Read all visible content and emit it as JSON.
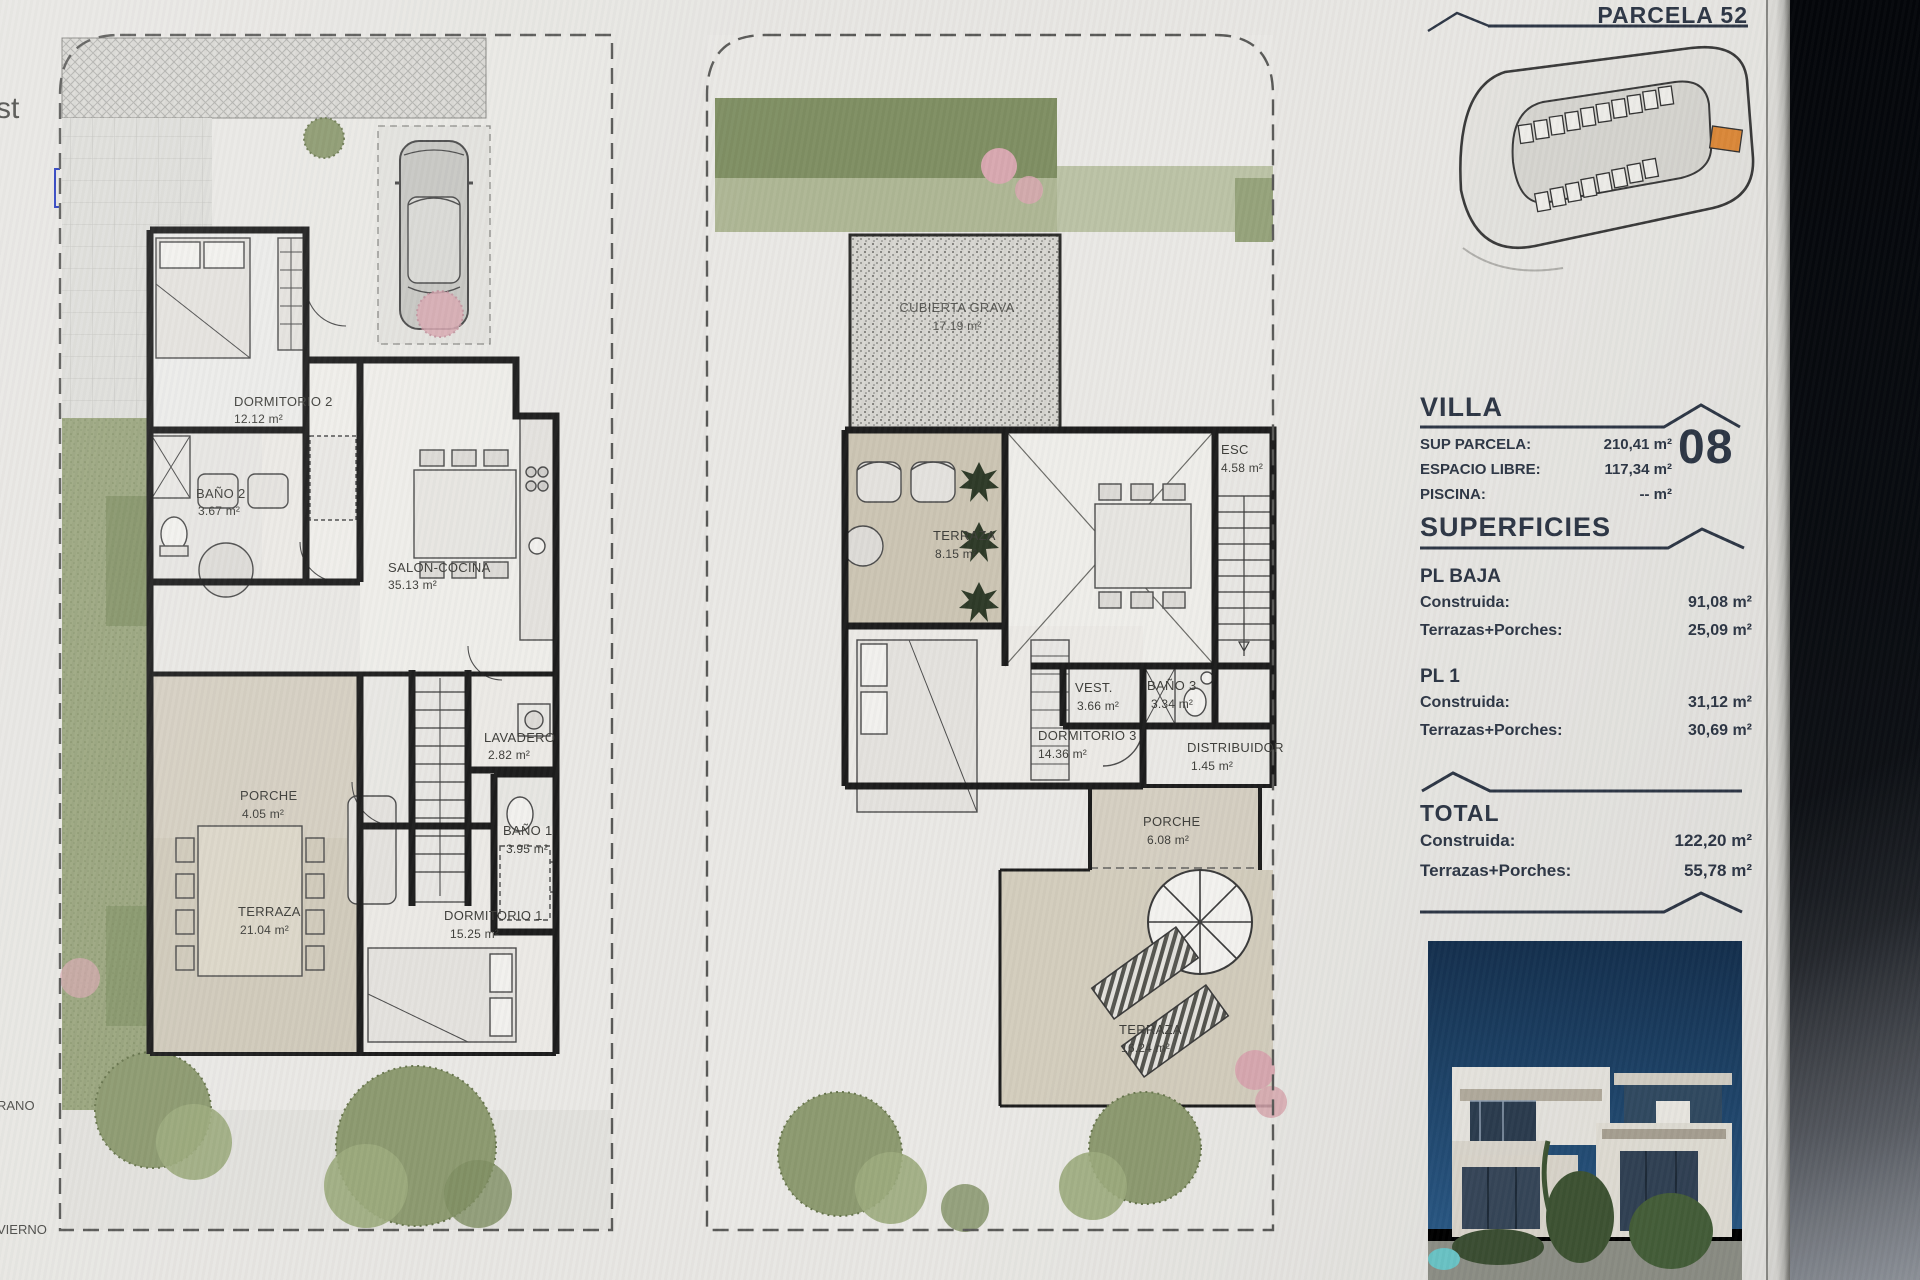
{
  "fragments": {
    "top": "st",
    "mid": "RANO",
    "bottom": "VIERNO"
  },
  "sidebar": {
    "parcel_title": "PARCELA 52",
    "villa": {
      "heading": "VILLA",
      "number": "08",
      "rows": [
        {
          "label": "SUP PARCELA:",
          "value": "210,41 m²"
        },
        {
          "label": "ESPACIO LIBRE:",
          "value": "117,34 m²"
        },
        {
          "label": "PISCINA:",
          "value": "--  m²"
        }
      ]
    },
    "superficies": {
      "heading": "SUPERFICIES",
      "groups": [
        {
          "title": "PL BAJA",
          "rows": [
            {
              "label": "Construida:",
              "value": "91,08 m²"
            },
            {
              "label": "Terrazas+Porches:",
              "value": "25,09 m²"
            }
          ]
        },
        {
          "title": "PL 1",
          "rows": [
            {
              "label": "Construida:",
              "value": "31,12 m²"
            },
            {
              "label": "Terrazas+Porches:",
              "value": "30,69 m²"
            }
          ]
        }
      ]
    },
    "total": {
      "heading": "TOTAL",
      "rows": [
        {
          "label": "Construida:",
          "value": "122,20 m²"
        },
        {
          "label": "Terrazas+Porches:",
          "value": "55,78 m²"
        }
      ]
    }
  },
  "plans": {
    "ground": {
      "rooms": [
        {
          "name": "DORMITORIO 2",
          "area": "12.12 m²"
        },
        {
          "name": "BAÑO 2",
          "area": "3.67 m²"
        },
        {
          "name": "SALON-COCINA",
          "area": "35.13 m²"
        },
        {
          "name": "LAVADERO",
          "area": "2.82 m²"
        },
        {
          "name": "PORCHE",
          "area": "4.05 m²"
        },
        {
          "name": "BAÑO 1",
          "area": "3.95 m²"
        },
        {
          "name": "TERRAZA",
          "area": "21.04 m²"
        },
        {
          "name": "DORMITORIO 1",
          "area": "15.25 m²"
        }
      ]
    },
    "first": {
      "rooms": [
        {
          "name": "CUBIERTA GRAVA",
          "area": "17.19 m²"
        },
        {
          "name": "TERRAZA",
          "area": "8.15 m²"
        },
        {
          "name": "ESC",
          "area": "4.58 m²"
        },
        {
          "name": "VEST.",
          "area": "3.66 m²"
        },
        {
          "name": "BAÑO 3",
          "area": "3.34 m²"
        },
        {
          "name": "DORMITORIO 3",
          "area": "14.36 m²"
        },
        {
          "name": "DISTRIBUIDOR",
          "area": "1.45 m²"
        },
        {
          "name": "PORCHE",
          "area": "6.08 m²"
        },
        {
          "name": "TERRAZA",
          "area": "16.24 m²"
        }
      ]
    }
  },
  "colors": {
    "accent_orange": "#dd8a3a",
    "ink": "#2e3746",
    "wall": "#1d1d1d",
    "green_dark": "#7f8f63",
    "green_mid": "#96a37b",
    "terrace_tan": "#ccc5b4",
    "sky": "#1d3a5c"
  }
}
